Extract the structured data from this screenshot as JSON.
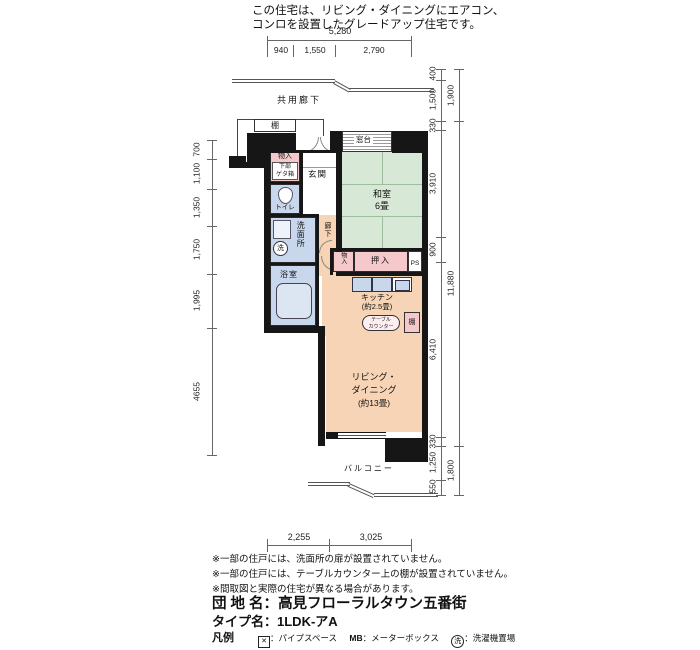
{
  "header": {
    "line1": "この住宅は、リビング・ダイニングにエアコン、",
    "line2": "コンロを設置したグレードアップ住宅です。"
  },
  "dims": {
    "top_total": "5,280",
    "top_segments": [
      "940",
      "1,550",
      "2,790"
    ],
    "left": [
      "700",
      "1,100",
      "1,350",
      "1,750",
      "1,995",
      "4655"
    ],
    "right_inner": [
      "400",
      "1,500",
      "330",
      "3,910",
      "900",
      "6,410",
      "330",
      "1,250",
      "550"
    ],
    "right_outer": [
      "1,900",
      "11,880",
      "1,800"
    ],
    "bottom": [
      "2,255",
      "3,025"
    ]
  },
  "plan": {
    "common_corridor": "共用廊下",
    "shelf": "棚",
    "entrance": "玄関",
    "entry_storage": "物入",
    "entry_storage_sub1": "下部",
    "entry_storage_sub2": "ゲタ箱",
    "window_sill": "窓台",
    "tatami_room": "和室",
    "tatami_size": "6畳",
    "toilet": "トイレ",
    "hallway": "廊下",
    "washroom": "洗面所",
    "washer": "洗",
    "bathroom": "浴室",
    "small_storage": "物入",
    "closet": "押入",
    "pipe_space": "PS",
    "kitchen": "キッチン",
    "kitchen_size": "(約2.5畳)",
    "table_counter_l1": "テーブル",
    "table_counter_l2": "カウンター",
    "kitchen_shelf": "棚",
    "living_l1": "リビング・",
    "living_l2": "ダイニング",
    "living_size": "(約13畳)",
    "balcony": "バルコニー"
  },
  "notes": [
    "※一部の住戸には、洗面所の扉が設置されていません。",
    "※一部の住戸には、テーブルカウンター上の棚が設置されていません。",
    "※間取図と実際の住宅が異なる場合があります。"
  ],
  "footer": {
    "estate_label": "団 地 名：",
    "estate_name": "高見フローラルタウン五番街",
    "type_label": "タイプ名：",
    "type_name": "1LDK-アA",
    "legend_title": "凡例",
    "legend1_sym": "✕",
    "legend1_text": "：パイプスペース",
    "legend2_sym": "MB",
    "legend2_text": "：メーターボックス",
    "legend3_sym": "洗",
    "legend3_text": "：洗濯機置場"
  },
  "colors": {
    "tatami_green": "#d7e9d6",
    "floor_peach": "#f7d4b5",
    "wet_blue": "#c8d7ec",
    "closet_pink": "#f5c8cc",
    "wall_black": "#161616"
  }
}
